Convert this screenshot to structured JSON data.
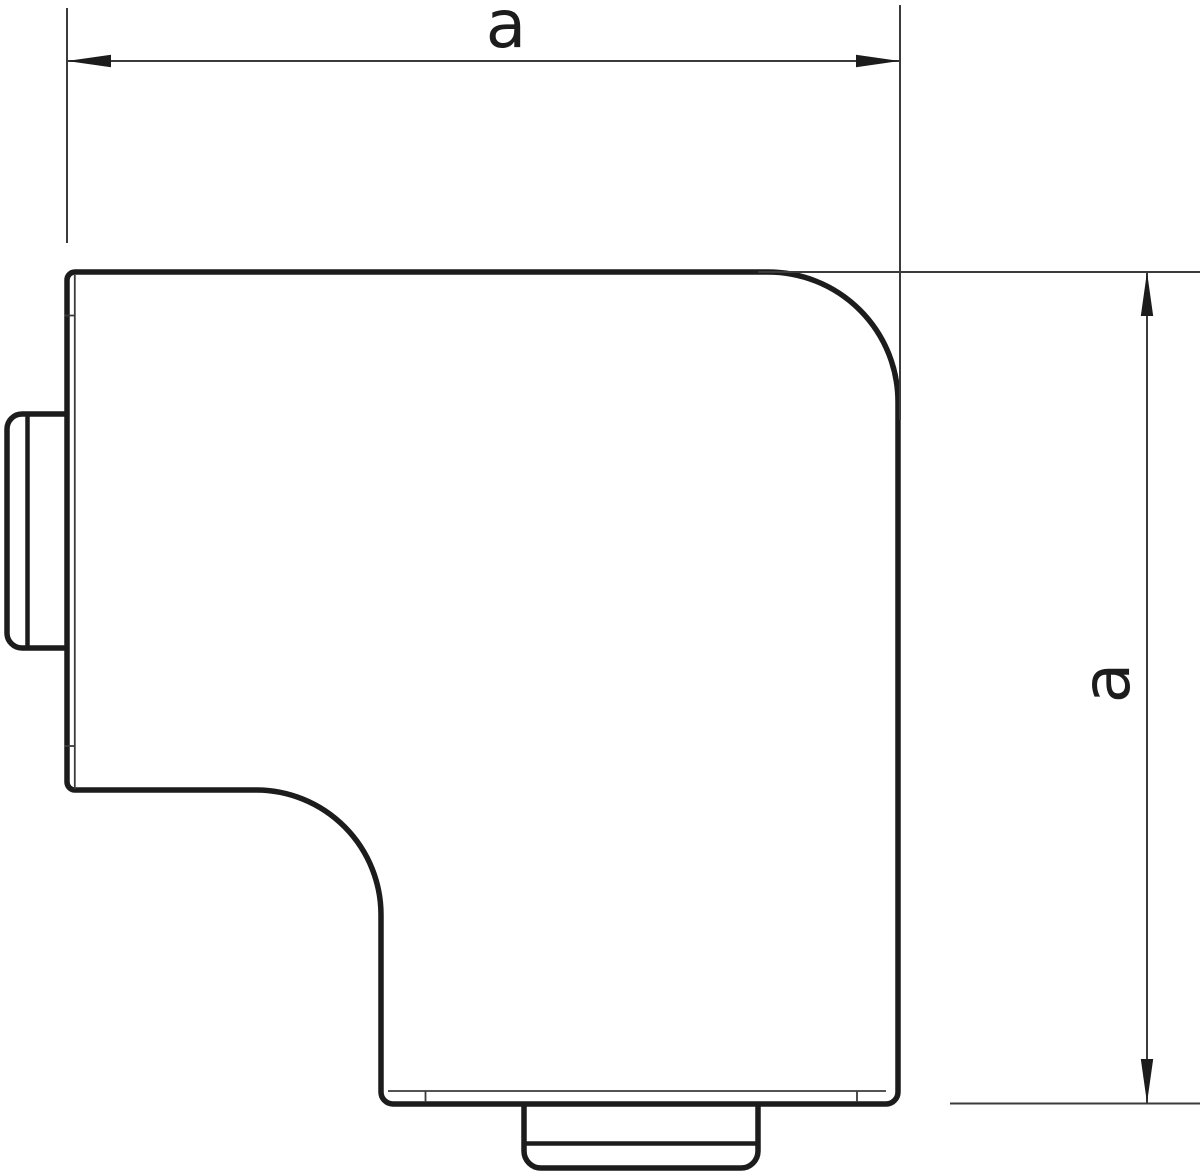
{
  "drawing": {
    "background_color": "#ffffff",
    "outline_color": "#1c1c1c",
    "thin_line_color": "#3b3b3b",
    "dimensions": {
      "horizontal": {
        "label": "a"
      },
      "vertical": {
        "label": "a"
      }
    }
  }
}
